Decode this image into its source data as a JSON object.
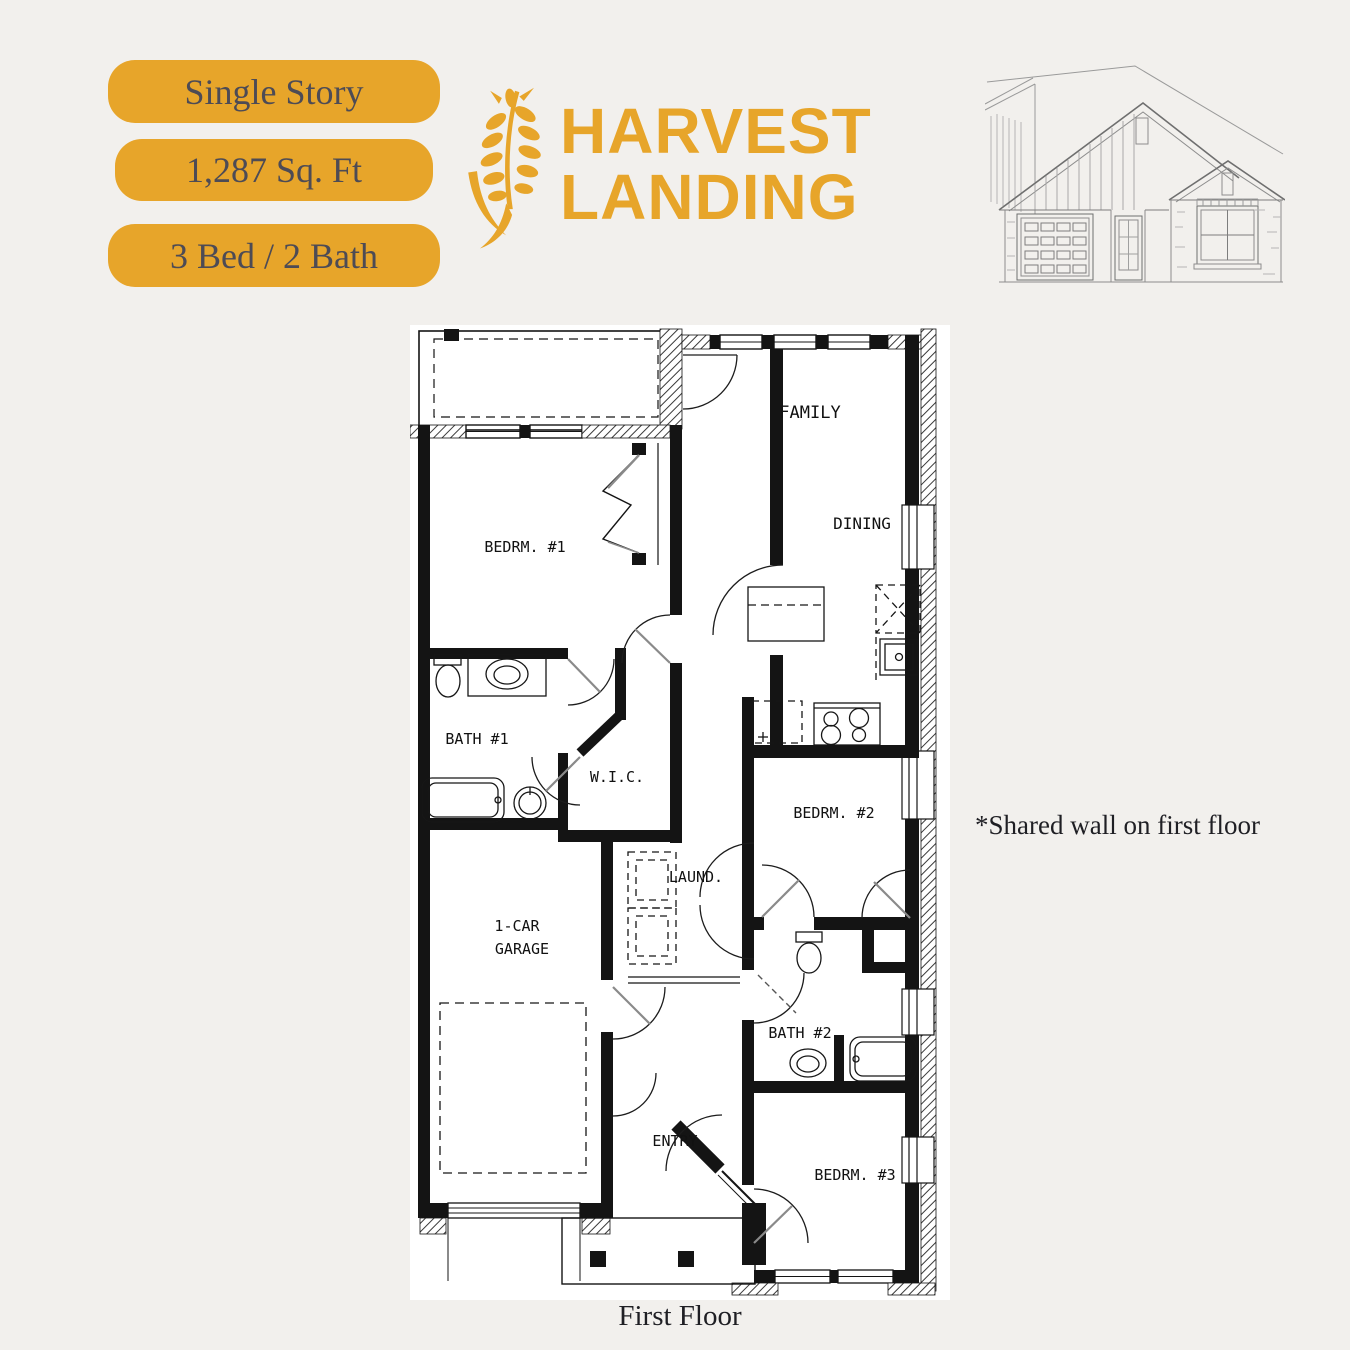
{
  "colors": {
    "background": "#f2f0ed",
    "accent_gold": "#e7a52a",
    "badge_text": "#4d4b55",
    "plan_line": "#141414",
    "sketch_line": "#8d8d8d"
  },
  "badges": [
    {
      "label": "Single Story"
    },
    {
      "label": "1,287 Sq. Ft"
    },
    {
      "label": "3 Bed / 2 Bath"
    }
  ],
  "logo": {
    "line1": "HARVEST",
    "line2": "LANDING",
    "icon": "wheat-icon"
  },
  "elevation": {
    "icon": "house-elevation-sketch"
  },
  "floor_plan": {
    "caption": "First Floor",
    "annotation": "*Shared wall on first floor",
    "rooms": {
      "family": "FAMILY",
      "dining": "DINING",
      "bedrm1": "BEDRM. #1",
      "bath1": "BATH #1",
      "wic": "W.I.C.",
      "laund": "LAUND.",
      "bedrm2": "BEDRM. #2",
      "garage_line1": "1-CAR",
      "garage_line2": "GARAGE",
      "bath2": "BATH #2",
      "entry": "ENTRY",
      "bedrm3": "BEDRM. #3"
    }
  }
}
